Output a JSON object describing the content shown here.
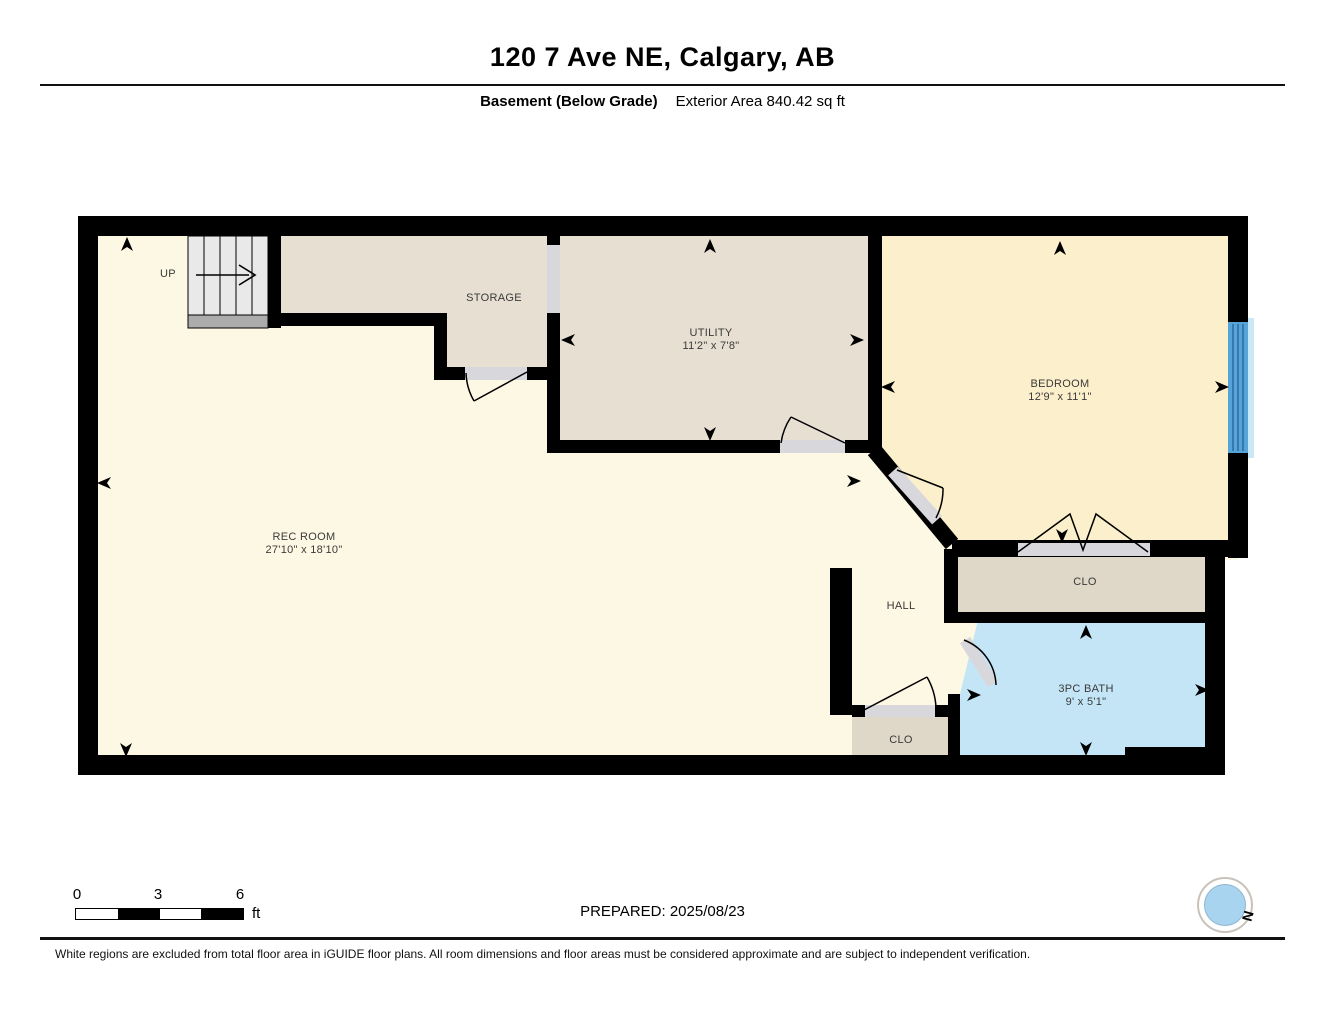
{
  "header": {
    "title": "120 7 Ave NE, Calgary, AB",
    "floor_label": "Basement (Below Grade)",
    "area_label": "Exterior Area 840.42 sq ft"
  },
  "rooms": {
    "rec_room": {
      "name": "REC ROOM",
      "dims": "27'10\" x 18'10\""
    },
    "storage": {
      "name": "STORAGE",
      "dims": ""
    },
    "utility": {
      "name": "UTILITY",
      "dims": "11'2\" x 7'8\""
    },
    "bedroom": {
      "name": "BEDROOM",
      "dims": "12'9\" x 11'1\""
    },
    "bedroom_closet": {
      "name": "CLO",
      "dims": ""
    },
    "hall": {
      "name": "HALL",
      "dims": ""
    },
    "hall_closet": {
      "name": "CLO",
      "dims": ""
    },
    "bath": {
      "name": "3PC BATH",
      "dims": "9' x 5'1\""
    },
    "stairs": {
      "label": "UP"
    }
  },
  "scale_bar": {
    "tick_0": "0",
    "tick_3": "3",
    "tick_6": "6",
    "unit": "ft"
  },
  "footer": {
    "prepared": "PREPARED: 2025/08/23",
    "compass_label": "N",
    "disclaimer": "White regions are excluded from total floor area in iGUIDE floor plans. All room dimensions and floor areas must be considered approximate and are subject to independent verification."
  },
  "colors": {
    "wall": "#000000",
    "rec_room_fill": "#FDF8E4",
    "bedroom_fill": "#FCEFCB",
    "storage_utility_fill": "#E7DFD2",
    "closet_fill": "#DFD7C7",
    "bath_fill": "#C3E5F6",
    "door_opening": "#D8D8DC",
    "window_blue": "#57A4D9",
    "stair_gray": "#E9E9E9",
    "landing_gray": "#ACACAC",
    "compass_blue": "#A9D4EF",
    "compass_needle_red": "#D62B1F"
  }
}
